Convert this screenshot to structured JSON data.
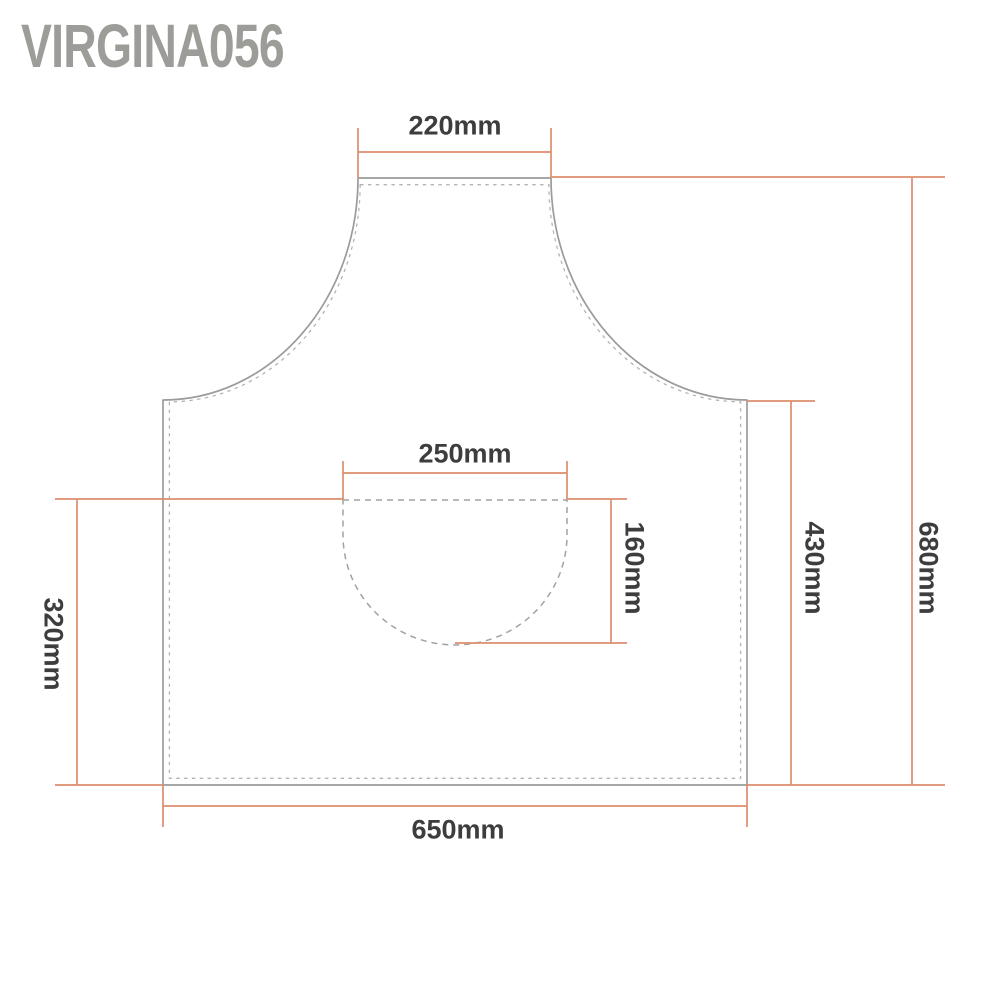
{
  "watermark": {
    "text": "Virgina056"
  },
  "diagram": {
    "subject": "apron-size-diagram",
    "unit": "mm",
    "dimensions": {
      "top_width": {
        "label": "220mm",
        "value": 220,
        "orientation": "horizontal",
        "describes": "bib top edge width"
      },
      "pocket_width": {
        "label": "250mm",
        "value": 250,
        "orientation": "horizontal",
        "describes": "pocket width"
      },
      "pocket_height": {
        "label": "160mm",
        "value": 160,
        "orientation": "vertical",
        "describes": "pocket height"
      },
      "lower_height": {
        "label": "320mm",
        "value": 320,
        "orientation": "vertical",
        "describes": "pocket top to hem height"
      },
      "side_height": {
        "label": "430mm",
        "value": 430,
        "orientation": "vertical",
        "describes": "underarm side height"
      },
      "total_height": {
        "label": "680mm",
        "value": 680,
        "orientation": "vertical",
        "describes": "overall apron height"
      },
      "bottom_width": {
        "label": "650mm",
        "value": 650,
        "orientation": "horizontal",
        "describes": "bottom hem width"
      }
    },
    "colors": {
      "dimension_line": "#dd8e6e",
      "outline": "#9b9b9b",
      "stitch_dash": "#b3b3b3",
      "pocket_dash": "#a2a2a2",
      "label_text": "#3d3d3d",
      "watermark_text": "#9c9c98",
      "background": "#ffffff"
    }
  }
}
